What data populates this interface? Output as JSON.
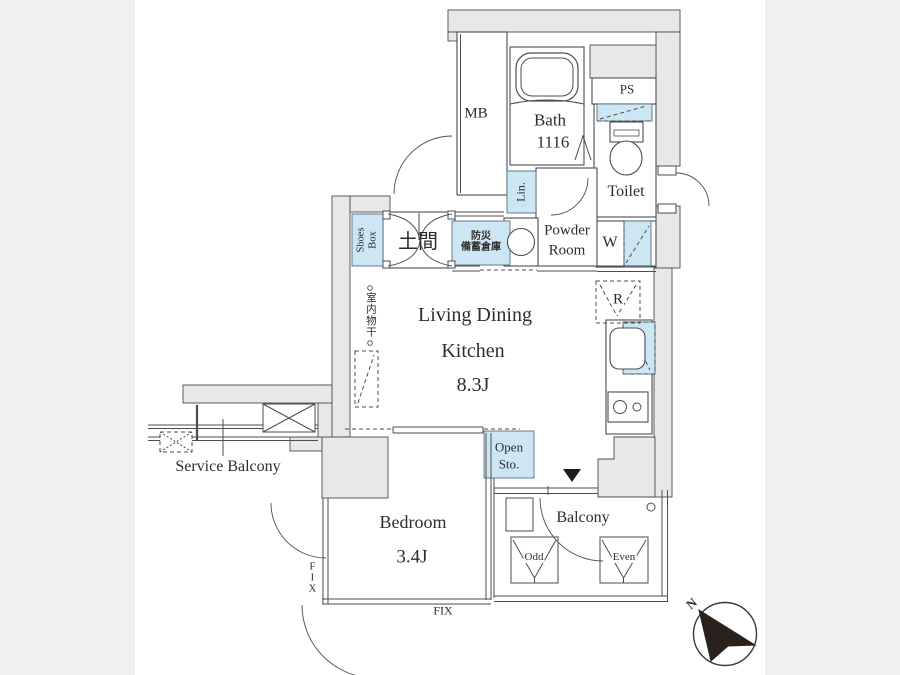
{
  "plan": {
    "type": "apartment-floor-plan",
    "colors": {
      "wall_fill": "#e7e9e8",
      "line": "#4a4d52",
      "highlight_blue": "#cde6f3",
      "letterbox_gray": "#efefef",
      "text": "#2d2d2d",
      "compass_fill": "#2a211c"
    },
    "labels": {
      "meter_box": "MB",
      "pipe_space": "PS",
      "bath": [
        "Bath",
        "1116"
      ],
      "toilet": "Toilet",
      "linen": "Lin.",
      "powder_room": [
        "Powder",
        "Room"
      ],
      "washer": "W",
      "shoes_box": [
        "Shoes",
        "Box"
      ],
      "doma": "土間",
      "disaster_storage": [
        "防災",
        "備蓄倉庫"
      ],
      "ldk": [
        "Living Dining",
        "Kitchen",
        "8.3J"
      ],
      "indoor_drying": "室内物干",
      "refrigerator": "R",
      "open_storage": [
        "Open",
        "Sto."
      ],
      "bedroom": [
        "Bedroom",
        "3.4J"
      ],
      "fix_window_side": "FIX",
      "fix_window_bottom": "FIX",
      "balcony": "Balcony",
      "ac_slot_odd": "Odd",
      "ac_slot_even": "Even",
      "service_balcony": "Service Balcony",
      "compass_north": "N"
    }
  }
}
